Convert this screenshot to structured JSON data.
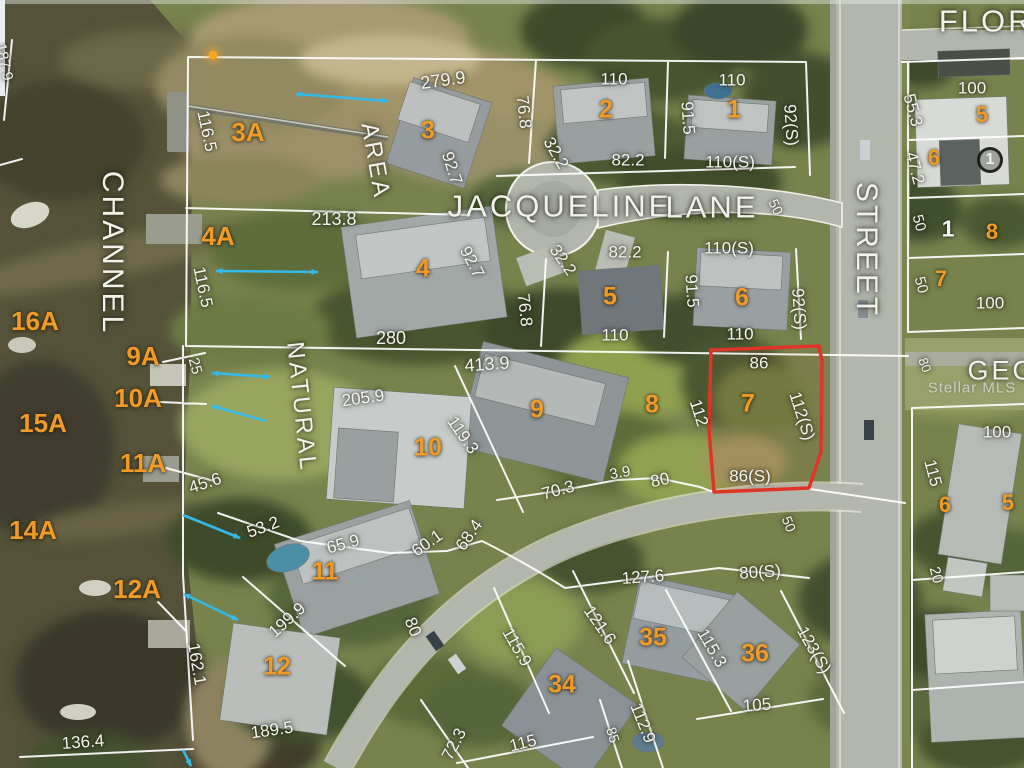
{
  "map": {
    "watermark": "Stellar MLS",
    "highlight": {
      "lot": "7",
      "color": "#e03428",
      "points": "711,350 819,346 822,361 821,452 809,488 714,492 709,430",
      "dimensions": {
        "north": "86",
        "west": "112",
        "east": "112(S)",
        "south": "86(S)"
      }
    },
    "colors": {
      "lot_number": "#f09b27",
      "dimension_text": "#f4f3ec",
      "arrow": "#35b9e9",
      "marker_dot": "#f5a623"
    },
    "marker_dot": {
      "x": 213,
      "y": 55
    },
    "arrows": [
      {
        "x1": 296,
        "y1": 94,
        "x2": 388,
        "y2": 101,
        "h": "both"
      },
      {
        "x1": 216,
        "y1": 271,
        "x2": 318,
        "y2": 272,
        "h": "both"
      },
      {
        "x1": 212,
        "y1": 373,
        "x2": 270,
        "y2": 377,
        "h": "both"
      },
      {
        "x1": 266,
        "y1": 421,
        "x2": 212,
        "y2": 406,
        "h": "end"
      },
      {
        "x1": 183,
        "y1": 515,
        "x2": 240,
        "y2": 538,
        "h": "end"
      },
      {
        "x1": 184,
        "y1": 594,
        "x2": 238,
        "y2": 620,
        "h": "both"
      },
      {
        "x1": 183,
        "y1": 750,
        "x2": 191,
        "y2": 766,
        "h": "end"
      }
    ],
    "labels": [
      {
        "t": "CHANNEL",
        "x": 112,
        "y": 253,
        "r": 90,
        "k": "street",
        "s": 30
      },
      {
        "t": "JACQUELINE",
        "x": 560,
        "y": 206,
        "r": 0,
        "k": "street",
        "s": 31
      },
      {
        "t": "LANE",
        "x": 712,
        "y": 207,
        "r": 0,
        "k": "street",
        "s": 31
      },
      {
        "t": "STREET",
        "x": 866,
        "y": 250,
        "r": 90,
        "k": "street",
        "s": 30
      },
      {
        "t": "FLORI",
        "x": 992,
        "y": 21,
        "r": 0,
        "k": "street",
        "s": 31
      },
      {
        "t": "NATURAL",
        "x": 301,
        "y": 407,
        "r": 84,
        "k": "street",
        "s": 24
      },
      {
        "t": "AREA",
        "x": 375,
        "y": 161,
        "r": 80,
        "k": "street",
        "s": 24
      },
      {
        "t": "GEO",
        "x": 1002,
        "y": 371,
        "r": 0,
        "k": "street",
        "s": 27
      },
      {
        "t": "Stellar MLS",
        "x": 972,
        "y": 388,
        "r": 0,
        "k": "watermark",
        "s": 15
      },
      {
        "t": "3A",
        "x": 248,
        "y": 132,
        "r": 0,
        "k": "lot",
        "s": 26
      },
      {
        "t": "3",
        "x": 428,
        "y": 131,
        "r": 0,
        "k": "lot",
        "s": 25
      },
      {
        "t": "2",
        "x": 606,
        "y": 110,
        "r": 0,
        "k": "lot",
        "s": 25
      },
      {
        "t": "1",
        "x": 734,
        "y": 110,
        "r": 0,
        "k": "lot",
        "s": 25
      },
      {
        "t": "4A",
        "x": 218,
        "y": 236,
        "r": 0,
        "k": "lot",
        "s": 26
      },
      {
        "t": "4",
        "x": 423,
        "y": 269,
        "r": 0,
        "k": "lot",
        "s": 25
      },
      {
        "t": "5",
        "x": 610,
        "y": 297,
        "r": 0,
        "k": "lot",
        "s": 25
      },
      {
        "t": "6",
        "x": 742,
        "y": 298,
        "r": 0,
        "k": "lot",
        "s": 25
      },
      {
        "t": "16A",
        "x": 35,
        "y": 321,
        "r": 0,
        "k": "lot",
        "s": 26
      },
      {
        "t": "9A",
        "x": 143,
        "y": 356,
        "r": 0,
        "k": "lot",
        "s": 26
      },
      {
        "t": "10A",
        "x": 138,
        "y": 398,
        "r": 0,
        "k": "lot",
        "s": 26
      },
      {
        "t": "15A",
        "x": 43,
        "y": 423,
        "r": 0,
        "k": "lot",
        "s": 26
      },
      {
        "t": "9",
        "x": 537,
        "y": 410,
        "r": 0,
        "k": "lot",
        "s": 25
      },
      {
        "t": "8",
        "x": 652,
        "y": 405,
        "r": 0,
        "k": "lot",
        "s": 25
      },
      {
        "t": "7",
        "x": 748,
        "y": 404,
        "r": 0,
        "k": "lot",
        "s": 25
      },
      {
        "t": "10",
        "x": 428,
        "y": 448,
        "r": 0,
        "k": "lot",
        "s": 25
      },
      {
        "t": "11A",
        "x": 143,
        "y": 463,
        "r": 0,
        "k": "lot",
        "s": 26
      },
      {
        "t": "14A",
        "x": 33,
        "y": 530,
        "r": 0,
        "k": "lot",
        "s": 26
      },
      {
        "t": "11",
        "x": 325,
        "y": 572,
        "r": 0,
        "k": "lot",
        "s": 25
      },
      {
        "t": "12A",
        "x": 137,
        "y": 589,
        "r": 0,
        "k": "lot",
        "s": 26
      },
      {
        "t": "12",
        "x": 277,
        "y": 667,
        "r": 0,
        "k": "lot",
        "s": 25
      },
      {
        "t": "34",
        "x": 562,
        "y": 685,
        "r": 0,
        "k": "lot",
        "s": 25
      },
      {
        "t": "35",
        "x": 653,
        "y": 638,
        "r": 0,
        "k": "lot",
        "s": 25
      },
      {
        "t": "36",
        "x": 755,
        "y": 654,
        "r": 0,
        "k": "lot",
        "s": 25
      },
      {
        "t": "5",
        "x": 982,
        "y": 115,
        "r": 0,
        "k": "lot",
        "s": 22
      },
      {
        "t": "6",
        "x": 934,
        "y": 158,
        "r": 0,
        "k": "lot",
        "s": 22
      },
      {
        "t": "8",
        "x": 992,
        "y": 232,
        "r": 0,
        "k": "lot",
        "s": 22
      },
      {
        "t": "7",
        "x": 941,
        "y": 279,
        "r": 0,
        "k": "lot",
        "s": 22
      },
      {
        "t": "6",
        "x": 945,
        "y": 505,
        "r": 0,
        "k": "lot",
        "s": 22
      },
      {
        "t": "5",
        "x": 1008,
        "y": 503,
        "r": 0,
        "k": "lot",
        "s": 22
      },
      {
        "t": "1",
        "x": 948,
        "y": 229,
        "r": 0,
        "k": "whitenum",
        "s": 23
      },
      {
        "t": "1",
        "x": 990,
        "y": 160,
        "r": 0,
        "k": "circled",
        "s": 16
      },
      {
        "t": "279.9",
        "x": 443,
        "y": 80,
        "r": -8,
        "k": "dim",
        "s": 18
      },
      {
        "t": "110",
        "x": 614,
        "y": 79,
        "r": 0,
        "k": "dim"
      },
      {
        "t": "110",
        "x": 732,
        "y": 80,
        "r": 0,
        "k": "dim"
      },
      {
        "t": "116.5",
        "x": 207,
        "y": 131,
        "r": 78,
        "k": "dim"
      },
      {
        "t": "92.7",
        "x": 452,
        "y": 168,
        "r": 72,
        "k": "dim"
      },
      {
        "t": "76.8",
        "x": 524,
        "y": 112,
        "r": 84,
        "k": "dim"
      },
      {
        "t": "91.5",
        "x": 688,
        "y": 118,
        "r": 86,
        "k": "dim"
      },
      {
        "t": "92(S)",
        "x": 791,
        "y": 125,
        "r": 86,
        "k": "dim"
      },
      {
        "t": "82.2",
        "x": 628,
        "y": 160,
        "r": 0,
        "k": "dim"
      },
      {
        "t": "110(S)",
        "x": 730,
        "y": 162,
        "r": 0,
        "k": "dim"
      },
      {
        "t": "32.2",
        "x": 556,
        "y": 153,
        "r": 60,
        "k": "dim"
      },
      {
        "t": "213.8",
        "x": 334,
        "y": 219,
        "r": 0,
        "k": "dim",
        "s": 18
      },
      {
        "t": "116.5",
        "x": 203,
        "y": 287,
        "r": 78,
        "k": "dim"
      },
      {
        "t": "92.7",
        "x": 472,
        "y": 262,
        "r": 62,
        "k": "dim"
      },
      {
        "t": "32.2",
        "x": 563,
        "y": 260,
        "r": 55,
        "k": "dim"
      },
      {
        "t": "82.2",
        "x": 625,
        "y": 252,
        "r": 0,
        "k": "dim"
      },
      {
        "t": "110(S)",
        "x": 729,
        "y": 248,
        "r": 0,
        "k": "dim"
      },
      {
        "t": "91.5",
        "x": 692,
        "y": 291,
        "r": 86,
        "k": "dim"
      },
      {
        "t": "92(S)",
        "x": 799,
        "y": 309,
        "r": 86,
        "k": "dim"
      },
      {
        "t": "76.8",
        "x": 525,
        "y": 310,
        "r": 84,
        "k": "dim"
      },
      {
        "t": "280",
        "x": 391,
        "y": 338,
        "r": 0,
        "k": "dim",
        "s": 18
      },
      {
        "t": "110",
        "x": 615,
        "y": 335,
        "r": 0,
        "k": "dim"
      },
      {
        "t": "110",
        "x": 740,
        "y": 334,
        "r": 0,
        "k": "dim"
      },
      {
        "t": "413.9",
        "x": 487,
        "y": 364,
        "r": -4,
        "k": "dim",
        "s": 18
      },
      {
        "t": "25",
        "x": 195,
        "y": 366,
        "r": 75,
        "k": "dim",
        "s": 15
      },
      {
        "t": "205.9",
        "x": 363,
        "y": 398,
        "r": -8,
        "k": "dim"
      },
      {
        "t": "119.3",
        "x": 463,
        "y": 435,
        "r": 55,
        "k": "dim"
      },
      {
        "t": "86",
        "x": 759,
        "y": 363,
        "r": 0,
        "k": "dim"
      },
      {
        "t": "112",
        "x": 699,
        "y": 413,
        "r": 72,
        "k": "dim"
      },
      {
        "t": "112(S)",
        "x": 802,
        "y": 416,
        "r": 72,
        "k": "dim"
      },
      {
        "t": "86(S)",
        "x": 750,
        "y": 476,
        "r": 0,
        "k": "dim"
      },
      {
        "t": "3.9",
        "x": 620,
        "y": 473,
        "r": -10,
        "k": "dim",
        "s": 15
      },
      {
        "t": "80",
        "x": 660,
        "y": 480,
        "r": -12,
        "k": "dim"
      },
      {
        "t": "70.3",
        "x": 558,
        "y": 490,
        "r": -15,
        "k": "dim"
      },
      {
        "t": "45.6",
        "x": 205,
        "y": 483,
        "r": -18,
        "k": "dim"
      },
      {
        "t": "53.2",
        "x": 263,
        "y": 527,
        "r": -20,
        "k": "dim"
      },
      {
        "t": "65.9",
        "x": 343,
        "y": 544,
        "r": -15,
        "k": "dim"
      },
      {
        "t": "60.1",
        "x": 427,
        "y": 543,
        "r": -35,
        "k": "dim"
      },
      {
        "t": "68.4",
        "x": 469,
        "y": 535,
        "r": -55,
        "k": "dim"
      },
      {
        "t": "199.9",
        "x": 287,
        "y": 620,
        "r": -42,
        "k": "dim"
      },
      {
        "t": "80",
        "x": 413,
        "y": 627,
        "r": 68,
        "k": "dim"
      },
      {
        "t": "162.1",
        "x": 197,
        "y": 664,
        "r": 80,
        "k": "dim"
      },
      {
        "t": "136.4",
        "x": 83,
        "y": 742,
        "r": -4,
        "k": "dim"
      },
      {
        "t": "189.5",
        "x": 272,
        "y": 730,
        "r": -8,
        "k": "dim"
      },
      {
        "t": "72.3",
        "x": 454,
        "y": 744,
        "r": -62,
        "k": "dim"
      },
      {
        "t": "115",
        "x": 523,
        "y": 743,
        "r": -14,
        "k": "dim"
      },
      {
        "t": "115.9",
        "x": 517,
        "y": 647,
        "r": 60,
        "k": "dim"
      },
      {
        "t": "121.6",
        "x": 600,
        "y": 625,
        "r": 55,
        "k": "dim"
      },
      {
        "t": "127.6",
        "x": 643,
        "y": 577,
        "r": -4,
        "k": "dim"
      },
      {
        "t": "115.3",
        "x": 712,
        "y": 648,
        "r": 60,
        "k": "dim"
      },
      {
        "t": "123(S)",
        "x": 814,
        "y": 650,
        "r": 60,
        "k": "dim"
      },
      {
        "t": "80(S)",
        "x": 760,
        "y": 572,
        "r": -4,
        "k": "dim"
      },
      {
        "t": "105",
        "x": 757,
        "y": 705,
        "r": -4,
        "k": "dim"
      },
      {
        "t": "112.9",
        "x": 643,
        "y": 723,
        "r": 68,
        "k": "dim"
      },
      {
        "t": "85",
        "x": 613,
        "y": 735,
        "r": 72,
        "k": "dim",
        "s": 14
      },
      {
        "t": "50",
        "x": 789,
        "y": 524,
        "r": 68,
        "k": "dim",
        "s": 14
      },
      {
        "t": "50",
        "x": 776,
        "y": 207,
        "r": 65,
        "k": "dim",
        "s": 14
      },
      {
        "t": "100",
        "x": 972,
        "y": 88,
        "r": 0,
        "k": "dim"
      },
      {
        "t": "55.3",
        "x": 913,
        "y": 110,
        "r": 75,
        "k": "dim"
      },
      {
        "t": "47.2",
        "x": 915,
        "y": 168,
        "r": 75,
        "k": "dim"
      },
      {
        "t": "50",
        "x": 919,
        "y": 223,
        "r": 75,
        "k": "dim",
        "s": 15
      },
      {
        "t": "50",
        "x": 921,
        "y": 285,
        "r": 75,
        "k": "dim",
        "s": 15
      },
      {
        "t": "100",
        "x": 990,
        "y": 303,
        "r": 0,
        "k": "dim"
      },
      {
        "t": "100",
        "x": 997,
        "y": 432,
        "r": 0,
        "k": "dim"
      },
      {
        "t": "115",
        "x": 933,
        "y": 473,
        "r": 75,
        "k": "dim"
      },
      {
        "t": "20",
        "x": 936,
        "y": 575,
        "r": 75,
        "k": "dim",
        "s": 15
      },
      {
        "t": "80",
        "x": 925,
        "y": 365,
        "r": 70,
        "k": "dim",
        "s": 13
      },
      {
        "t": "187.9",
        "x": 4,
        "y": 62,
        "r": 78,
        "k": "dim",
        "s": 15
      }
    ]
  }
}
